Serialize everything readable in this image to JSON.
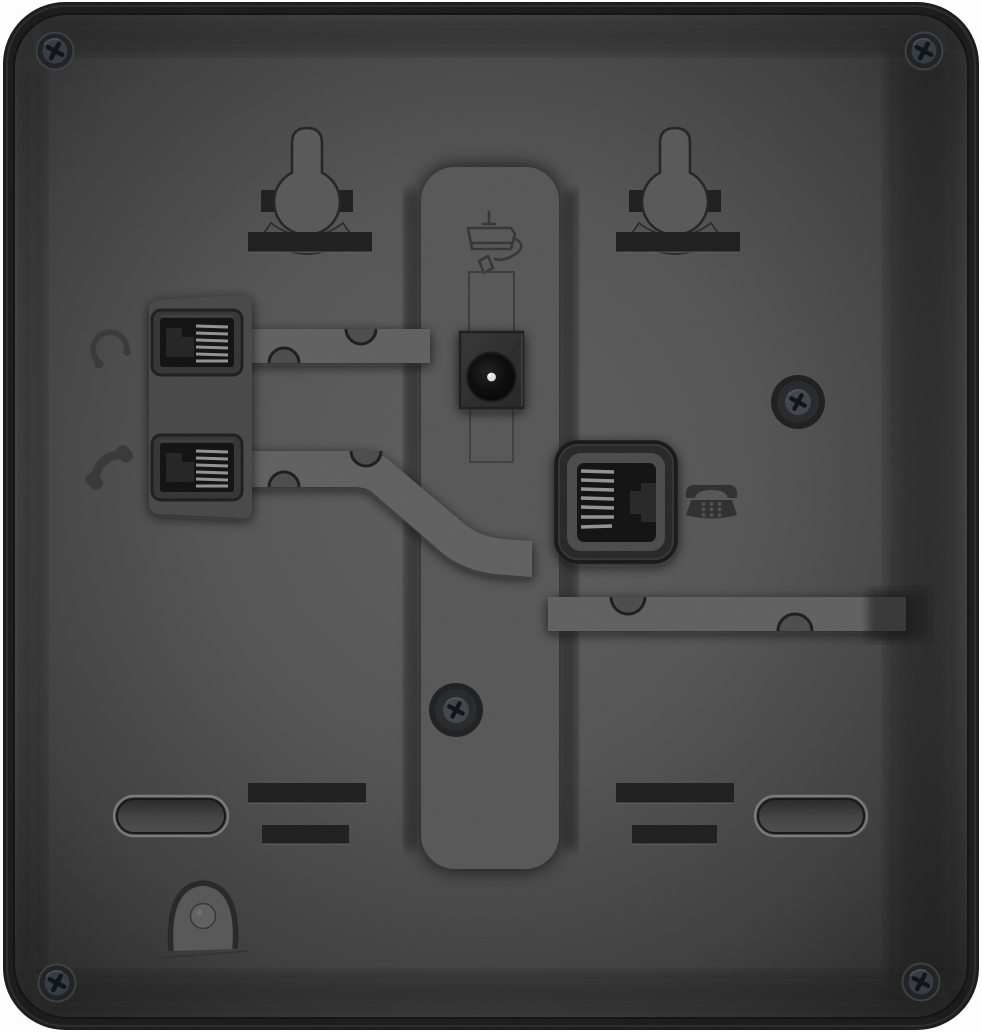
{
  "colors": {
    "page_bg": "#ffffff",
    "shell": "#191919",
    "shell_rim": "#343434",
    "panel_center": "#5d5d5d",
    "panel_edge": "#232323",
    "rail": "#565656",
    "channel": "#5e5e5e",
    "notch_fill": "#4b4b4b",
    "notch_line": "#1c1c1c",
    "slot": "#1d1d1d",
    "engraving": "#373737",
    "keyhole_fill": "#575757",
    "keyhole_line": "#232323",
    "plate": "#464646",
    "jack_bezel": "#343434",
    "socket": "#101010",
    "plug_step": "#262626",
    "contacts": "#929292",
    "line_port_bezel": "#272727",
    "line_port_face": "#4a4a4a",
    "power_housing": "#2e2e2e",
    "power_hole": "#0a0a0a",
    "power_pin": "#e2e2e2",
    "phone_icon": "#2e2e2e",
    "screw_ring": "#202428",
    "screw_head": "#363c42",
    "screw_cross": "#0e1113",
    "foot_rim": "#828282",
    "foot_fill": "#3d3d3d",
    "hook_fill": "#565656",
    "hook_line": "#262626"
  },
  "icons": {
    "headset": "headset-icon",
    "handset": "handset-icon",
    "power_adapter": "power-adapter-icon",
    "telephone": "telephone-icon",
    "screw": "phillips-screw"
  },
  "features": {
    "wall_mount_keyholes": 2,
    "mount_slots_top": 2,
    "mount_slots_bottom": 4,
    "corner_screws": 4,
    "panel_screws": 2,
    "rubber_feet": 2,
    "ports": [
      "headset",
      "handset",
      "power",
      "line"
    ],
    "cable_channels": 3,
    "cable_hook": 1
  }
}
